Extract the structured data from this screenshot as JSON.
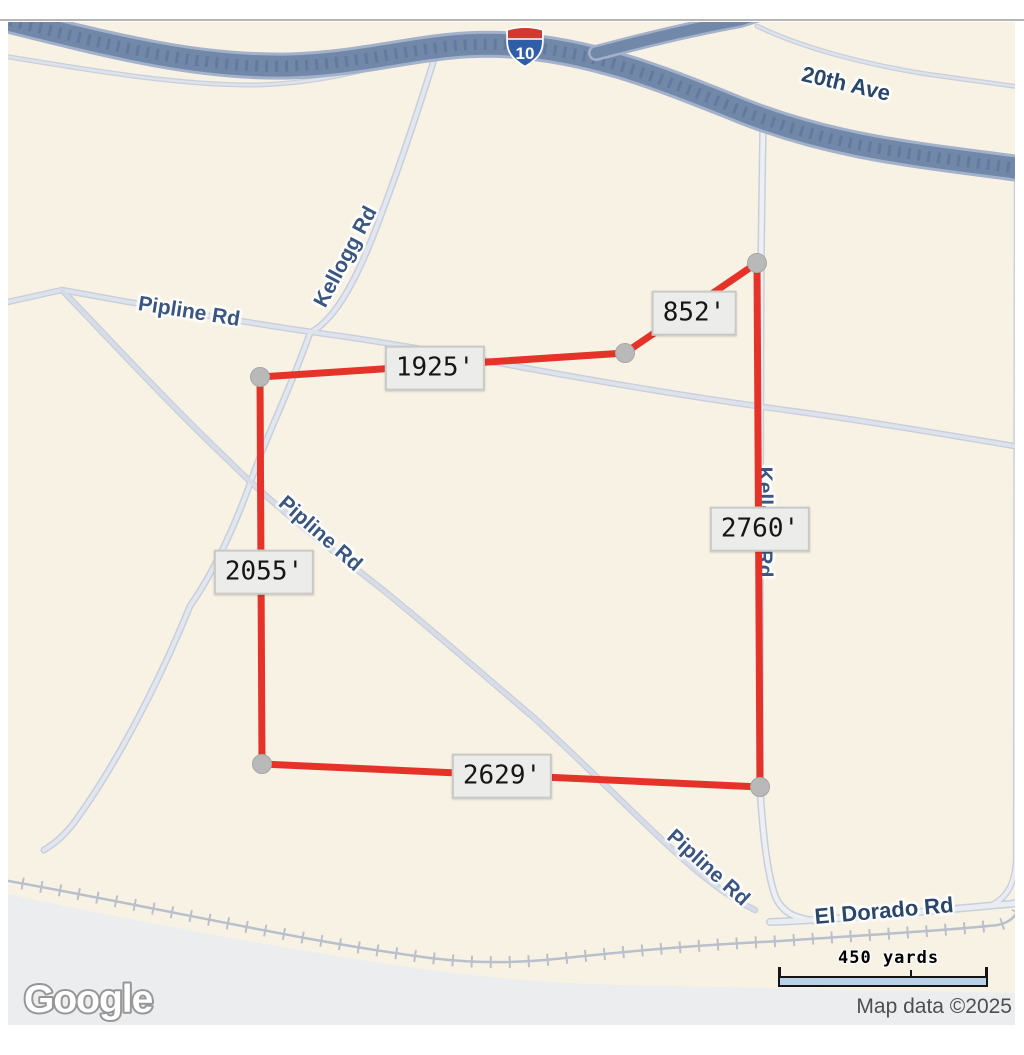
{
  "map": {
    "provider": "Google",
    "attribution": "Map data ©2025",
    "scale_label": "450 yards",
    "shield_label": "10",
    "road_labels": [
      {
        "id": "20th-ave",
        "text": "20th Ave"
      },
      {
        "id": "kellogg-nw",
        "text": "Kellogg Rd"
      },
      {
        "id": "pipline-w",
        "text": "Pipline Rd"
      },
      {
        "id": "pipline-mid",
        "text": "Pipline Rd"
      },
      {
        "id": "kellogg-e",
        "text": "Kellogg Rd"
      },
      {
        "id": "pipline-s",
        "text": "Pipline Rd"
      },
      {
        "id": "el-dorado",
        "text": "El Dorado Rd"
      }
    ],
    "measurements": [
      {
        "edge": "north",
        "label": "1925'"
      },
      {
        "edge": "northeast",
        "label": "852'"
      },
      {
        "edge": "east",
        "label": "2760'"
      },
      {
        "edge": "west",
        "label": "2055'"
      },
      {
        "edge": "south",
        "label": "2629'"
      }
    ],
    "colors": {
      "land": "#f7f2e3",
      "terrain_gray": "#ebedef",
      "highway_fill": "#7288a9",
      "highway_edge": "#a3b1ca",
      "minor_road": "#e2e6ee",
      "parcel_line": "#e5332a",
      "vertex_dot": "#b9b9b9",
      "label_blue": "#3a5680",
      "scale_bar_fill": "#b9d2ea"
    }
  }
}
